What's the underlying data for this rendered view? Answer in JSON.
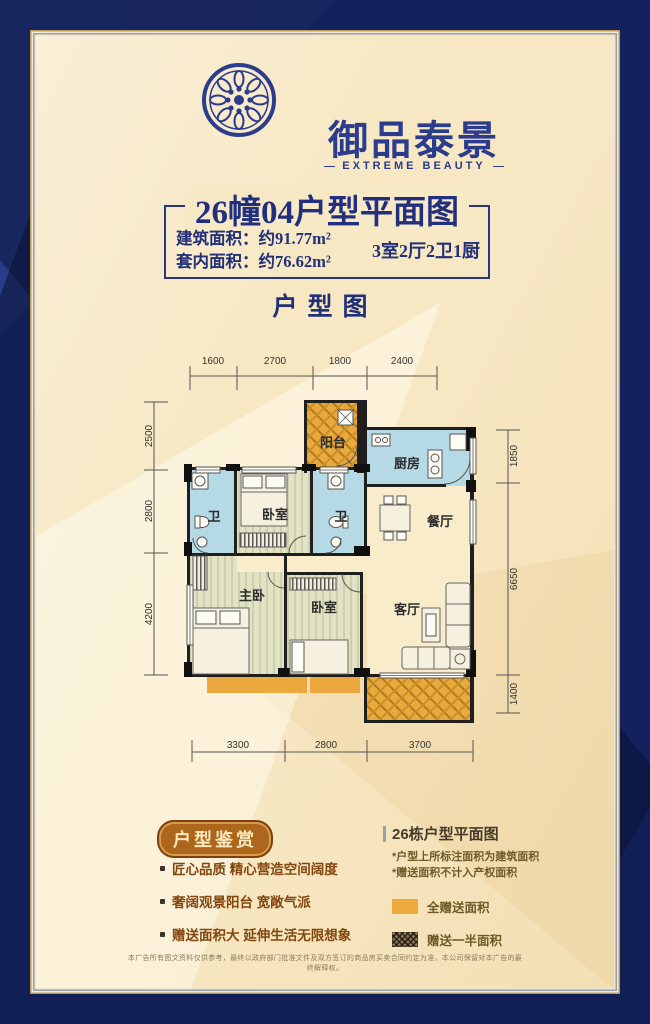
{
  "brand": {
    "name": "御品泰景",
    "tagline": "EXTREME BEAUTY"
  },
  "unit": {
    "title": "26幢04户型平面图",
    "build_area": "建筑面积：约91.77m²",
    "inner_area": "套内面积：约76.62m²",
    "rooms_summary": "3室2厅2卫1厨"
  },
  "section_title": "户型图",
  "plan": {
    "rooms": {
      "balcony": "阳台",
      "kitchen": "厨房",
      "dining": "餐厅",
      "bath": "卫",
      "bedroom": "卧室",
      "master": "主卧",
      "living": "客厅"
    },
    "dims": {
      "top": [
        "1600",
        "2700",
        "1800",
        "2400"
      ],
      "left": [
        "2500",
        "2800",
        "4200"
      ],
      "right": [
        "1850",
        "6650",
        "1400"
      ],
      "bottom": [
        "3300",
        "2800",
        "3700"
      ]
    }
  },
  "appreciation": {
    "badge": "户型鉴赏",
    "bullets": [
      "匠心品质 精心营造空间阔度",
      "奢阔观景阳台 宽敞气派",
      "赠送面积大 延伸生活无限想象"
    ]
  },
  "notes": {
    "title": "26栋户型平面图",
    "items": [
      "*户型上所标注面积为建筑面积",
      "*赠送面积不计入产权面积"
    ]
  },
  "legend": {
    "full": "全赠送面积",
    "half": "赠送一半面积"
  },
  "disclaimer": "本广告所有图文资料仅供参考，最终以政府部门批准文件及双方签订的商品房买卖合同约定为准，本公司保留对本广告的最终解释权。",
  "colors": {
    "border_navy": "#1c3184",
    "accent_navy": "#222e7e",
    "cream_bg": "#f7e7c2",
    "balcony_orange": "#e9a93c",
    "wet_room_blue": "#b5d9e5",
    "bedroom_green": "#e2e3c6",
    "badge_orange": "#ad661c"
  }
}
